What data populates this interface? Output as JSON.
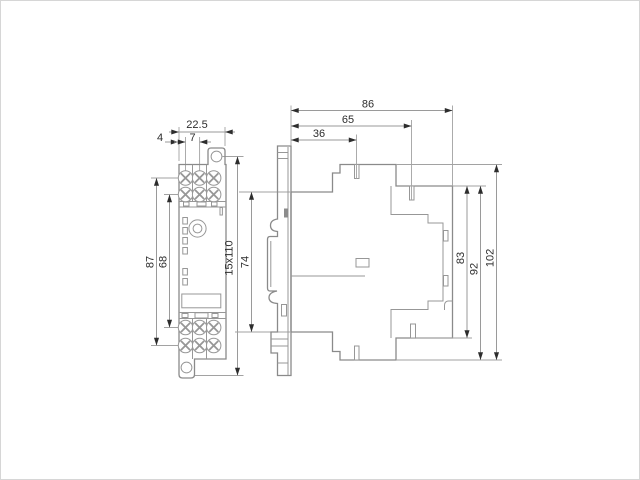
{
  "drawing": {
    "type": "technical-dimension-drawing",
    "views": {
      "front": {
        "name": "front view"
      },
      "side": {
        "name": "side view"
      }
    },
    "dimensions": {
      "front_width": "22.5",
      "terminal_pitch": "7",
      "edge_to_first_terminal": "4",
      "terminal_span_outer": "87",
      "terminal_span_inner": "68",
      "din_rail": "15x110",
      "housing_height": "74",
      "depth_total": "86",
      "depth_upper_screw": "65",
      "depth_lower_screw": "36",
      "height_terminal": "83",
      "height_body": "92",
      "height_total": "102"
    },
    "colors": {
      "background": "#ffffff",
      "line": "#8a8a8a",
      "text": "#2d2d2d",
      "accent_fill": "#8c8c8c"
    }
  }
}
